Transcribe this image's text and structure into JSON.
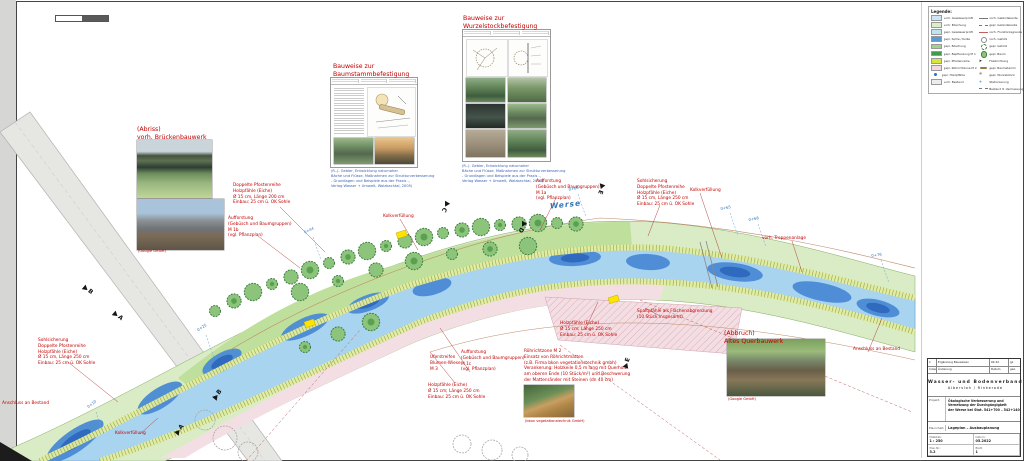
{
  "legend": {
    "title": "Legende:",
    "left_items": [
      {
        "color": "#cfe6f4",
        "label": "vorh. Gewässerprofil"
      },
      {
        "color": "#dcedcb",
        "label": "vorh. Böschung"
      },
      {
        "color": "#bfe4f0",
        "label": "gepl. Gewässerprofil"
      },
      {
        "color": "#5b9bd5",
        "label": "gepl. Sohle / Kolke"
      },
      {
        "color": "#9fd48c",
        "label": "gepl. Böschung"
      },
      {
        "color": "#3f9b49",
        "label": "gepl. Bepflanzung M 1"
      },
      {
        "color": "#d8e53c",
        "label": "gepl. Pfostenreihe"
      },
      {
        "color": "#f2dade",
        "label": "gepl. Röhrichtzone M 2"
      },
      {
        "color": "dot",
        "label": "gepl. Holzpfähle"
      },
      {
        "color": "#ededed",
        "label": "vorh. Bestand"
      }
    ],
    "right_items": [
      {
        "glyph": "line",
        "label": "vorh. Geländekante"
      },
      {
        "glyph": "dash",
        "label": "gepl. Geländekante"
      },
      {
        "glyph": "thin",
        "label": "vorh. Flurstücksgrenze"
      },
      {
        "glyph": "circle",
        "label": "vorh. Gehölz"
      },
      {
        "glyph": "scallop",
        "label": "gepl. Gehölz"
      },
      {
        "glyph": "tree",
        "label": "gepl. Baum"
      },
      {
        "glyph": "arrow",
        "label": "Fließrichtung"
      },
      {
        "glyph": "log",
        "label": "gepl. Baumstamm"
      },
      {
        "glyph": "root",
        "label": "gepl. Wurzelstock"
      },
      {
        "glyph": "tick",
        "label": "Stationierung"
      },
      {
        "glyph": "dash",
        "label": "Bestand lt. Vermessung"
      }
    ]
  },
  "annotations": [
    {
      "x": 137,
      "y": 126,
      "cls": "lg",
      "lines": [
        "(Abriss)",
        "vorh. Brückenbauwerk"
      ]
    },
    {
      "x": 138,
      "y": 249,
      "cls": "xs",
      "lines": [
        "(Google GmbH)"
      ]
    },
    {
      "x": 333,
      "y": 63,
      "cls": "lg",
      "lines": [
        "Bauweise zur",
        "Baumstammbefestigung"
      ]
    },
    {
      "x": 331,
      "y": 169,
      "cls": "xs blue",
      "lines": [
        "(R.-J. Gebler, Entwicklung naturnaher",
        "Bäche und Flüsse, Maßnahmen zur Strukturverbesserung",
        "- Grundlagen und Beispiele aus der Praxis -,",
        "Verlag Wasser + Umwelt, Walzbachtal, 2005)"
      ]
    },
    {
      "x": 463,
      "y": 15,
      "cls": "lg",
      "lines": [
        "Bauweise zur",
        "Wurzelstockbefestigung"
      ]
    },
    {
      "x": 462,
      "y": 164,
      "cls": "xs blue",
      "lines": [
        "(R.-J. Gebler, Entwicklung naturnaher",
        "Bäche und Flüsse, Maßnahmen zur Strukturverbesserung",
        "- Grundlagen und Beispiele aus der Praxis -,",
        "Verlag Wasser + Umwelt, Walzbachtal, 2005)"
      ]
    },
    {
      "x": 233,
      "y": 183,
      "cls": "",
      "lines": [
        "Doppelte Pfostenreihe",
        "Holzpfähle (Eiche)",
        "Ø 15 cm, Länge 200 cm",
        "Einbau: 25 cm ü. OK Sohle"
      ]
    },
    {
      "x": 228,
      "y": 216,
      "cls": "",
      "lines": [
        "Aufforstung",
        "(Gebüsch und Baumgruppen)",
        "M 1b",
        "(vgl. Pflanzplan)"
      ]
    },
    {
      "x": 536,
      "y": 179,
      "cls": "",
      "lines": [
        "Aufforstung",
        "(Gebüsch und Baumgruppen)",
        "M 1a",
        "(vgl. Pflanzplan)"
      ]
    },
    {
      "x": 637,
      "y": 179,
      "cls": "",
      "lines": [
        "Sohlsicherung",
        "Doppelte Pfostenreihe",
        "Holzpfähle (Eiche)",
        "Ø 15 cm, Länge 250 cm",
        "Einbau: 25 cm ü. OK Sohle"
      ]
    },
    {
      "x": 690,
      "y": 188,
      "cls": "",
      "lines": [
        "Kolkverfüllung"
      ]
    },
    {
      "x": 383,
      "y": 214,
      "cls": "",
      "lines": [
        "Kolkverfüllung"
      ]
    },
    {
      "x": 762,
      "y": 236,
      "cls": "",
      "lines": [
        "vorh. Treppenanlage"
      ]
    },
    {
      "x": 38,
      "y": 338,
      "cls": "",
      "lines": [
        "Sohlsicherung",
        "Doppelte Pfostenreihe",
        "Holzpfähle (Eiche)",
        "Ø 15 cm, Länge 250 cm",
        "Einbau: 25 cm ü. OK Sohle"
      ]
    },
    {
      "x": 2,
      "y": 401,
      "cls": "",
      "lines": [
        "Anschluss an Bestand"
      ]
    },
    {
      "x": 115,
      "y": 431,
      "cls": "",
      "lines": [
        "Kolkverfüllung"
      ]
    },
    {
      "x": 430,
      "y": 355,
      "cls": "",
      "lines": [
        "Uferstreifen",
        "Blumen-Wiese",
        "M 3"
      ]
    },
    {
      "x": 461,
      "y": 350,
      "cls": "",
      "lines": [
        "Aufforstung",
        "(Gebüsch und Baumgruppen)",
        "M 1c",
        "(vgl. Pflanzplan)"
      ]
    },
    {
      "x": 428,
      "y": 383,
      "cls": "",
      "lines": [
        "Holzpfähle (Eiche)",
        "Ø 15 cm; Länge 250 cm",
        "Einbau: 25 cm ü. OK Sohle"
      ]
    },
    {
      "x": 560,
      "y": 321,
      "cls": "",
      "lines": [
        "Holzpfähle (Eiche)",
        "Ø 15 cm; Länge 250 cm",
        "Einbau: 25 cm ü. OK Sohle"
      ]
    },
    {
      "x": 637,
      "y": 309,
      "cls": "",
      "lines": [
        "Spaltpfähle als Flächenabgrenzung",
        "(10 Stück insgesamt)"
      ]
    },
    {
      "x": 524,
      "y": 349,
      "cls": "",
      "lines": [
        "Röhrichtzone M 2",
        "Einsatz von Röhrichtmatten",
        "(z.B. Firma bkon vegetationstechnik gmbh)",
        "Verankerung: Holzkeile 0,5 m lang mit Querholz",
        "am oberen Ende (10 Stück/m²) und Beschwerung",
        "der Mattenränder mit Steinen (dn 40 cm)"
      ]
    },
    {
      "x": 525,
      "y": 419,
      "cls": "xs",
      "lines": [
        "(bkon vegetationstechnik GmbH)"
      ]
    },
    {
      "x": 724,
      "y": 330,
      "cls": "lg",
      "lines": [
        "(Abbruch)",
        "Altes Querbauwerk"
      ]
    },
    {
      "x": 728,
      "y": 397,
      "cls": "xs",
      "lines": [
        "(Google GmbH)"
      ]
    },
    {
      "x": 853,
      "y": 347,
      "cls": "",
      "lines": [
        "Anschluss an Bestand"
      ]
    },
    {
      "x": 550,
      "y": 200,
      "cls": "werse",
      "lines": [
        "Werse"
      ]
    }
  ],
  "stations": [
    {
      "x": 86,
      "y": 405,
      "label": "0+10",
      "rot": -38
    },
    {
      "x": 196,
      "y": 328,
      "label": "0+25",
      "rot": -33
    },
    {
      "x": 303,
      "y": 230,
      "label": "0+44",
      "rot": -25
    },
    {
      "x": 568,
      "y": 187,
      "label": "0+60",
      "rot": -12
    },
    {
      "x": 720,
      "y": 206,
      "label": "0+65",
      "rot": -10
    },
    {
      "x": 748,
      "y": 217,
      "label": "0+68",
      "rot": -10
    },
    {
      "x": 871,
      "y": 253,
      "label": "0+76",
      "rot": -8
    }
  ],
  "markers": [
    {
      "x": 84,
      "y": 283,
      "letter": "B",
      "rot": 40
    },
    {
      "x": 114,
      "y": 309,
      "letter": "A",
      "rot": 40
    },
    {
      "x": 176,
      "y": 430,
      "letter": "A",
      "rot": -50
    },
    {
      "x": 214,
      "y": 395,
      "letter": "B",
      "rot": -50
    },
    {
      "x": 448,
      "y": 199,
      "letter": "C",
      "rot": 120
    },
    {
      "x": 525,
      "y": 219,
      "letter": "D",
      "rot": 120
    },
    {
      "x": 603,
      "y": 181,
      "letter": "E",
      "rot": 110
    },
    {
      "x": 625,
      "y": 364,
      "letter": "E",
      "rot": -70
    }
  ],
  "titleblock": {
    "revisions": [
      {
        "a": "1",
        "b": "Ergänzung Bauweisen",
        "c": "04.22",
        "d": "gz"
      },
      {
        "a": "Index",
        "b": "Änderung",
        "c": "Datum",
        "d": "gez."
      }
    ],
    "org1": "Wasser- und Bodenverband",
    "org2": "Albersloh / Rinkerode",
    "project_label": "Projekt:",
    "project": [
      "Ökologische Verbesserung und",
      "Vernetzung der Durchgängigkeit",
      "der Werse bei Stat. 541+700 – 542+140"
    ],
    "plan_label": "Planinhalt:",
    "plan": "Lageplan – Ausbauplanung",
    "cells": [
      {
        "l": "Maßstab:",
        "v": "1 : 250"
      },
      {
        "l": "Datum:",
        "v": "05.2022"
      },
      {
        "l": "Plan-Nr.:",
        "v": "3.2"
      },
      {
        "l": "Blatt:",
        "v": "1"
      }
    ]
  }
}
